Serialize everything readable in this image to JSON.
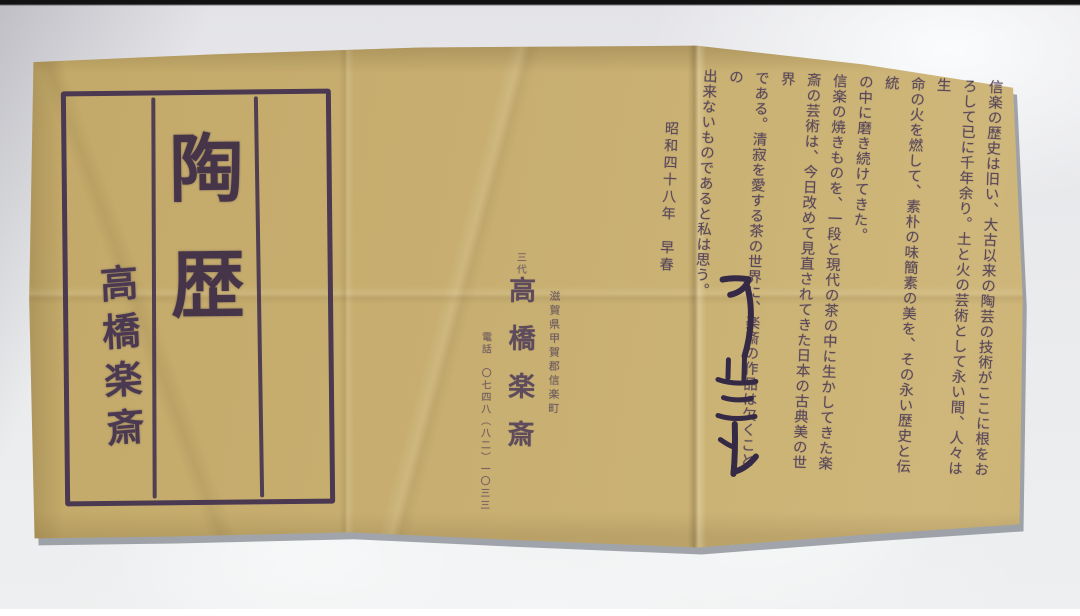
{
  "title_box": {
    "title_char_1": "陶",
    "title_char_2": "歴",
    "signature": "高橋楽斎"
  },
  "publisher": {
    "generation": "三代",
    "name": "高橋楽斎",
    "address": "滋賀県甲賀郡信楽町",
    "phone": "電話　〇七四八（八二）一〇三三"
  },
  "body": {
    "lines": [
      "信楽の歴史は旧い、大古以来の陶芸の技術がここに根をお",
      "ろして已に千年余り。土と火の芸術として永い間、人々は生",
      "命の火を燃して、素朴の味簡素の美を、その永い歴史と伝統",
      "の中に磨き続けてきた。",
      "信楽の焼きものを、一段と現代の茶の中に生かしてきた楽",
      "斎の芸術は、今日改めて見直されてきた日本の古典美の世界",
      "である。清寂を愛する茶の世界に、楽斎の作品は欠くことの",
      "出来ないものであると私は思う。"
    ],
    "date_line": "昭和四十八年　早春"
  },
  "colors": {
    "paper": "#c7ae70",
    "ink": "#4a3950",
    "body_ink": "#5a485a",
    "background": "#e9eaec"
  }
}
